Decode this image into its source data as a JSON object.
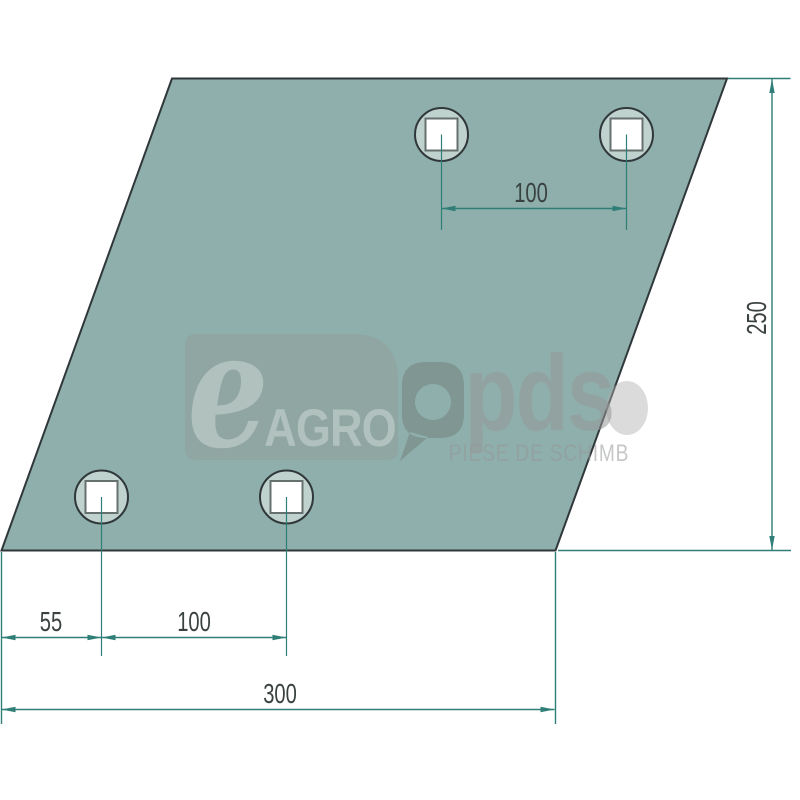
{
  "diagram": {
    "type": "technical-drawing",
    "part_shape": "parallelogram-plate-with-4-square-holes",
    "unit": "mm",
    "labels": {
      "top_hole_spacing": "100",
      "height": "250",
      "left_edge_to_hole": "55",
      "bottom_hole_spacing": "100",
      "width": "300"
    },
    "hole_count": 4
  },
  "watermark": {
    "e": "e",
    "agro": "AGRO",
    "pds": "pds",
    "tagline": "PIESE DE SCHIMB"
  },
  "colors": {
    "background": "#FFFFFF",
    "plate_fill": "#8EAFAB",
    "plate_outline": "#30373A",
    "dimension_line": "#2F7E77",
    "dimension_text": "#3A4241",
    "hole_ring_fill": "#BFD2CE",
    "hole_square_fill": "#FFFFFF"
  }
}
